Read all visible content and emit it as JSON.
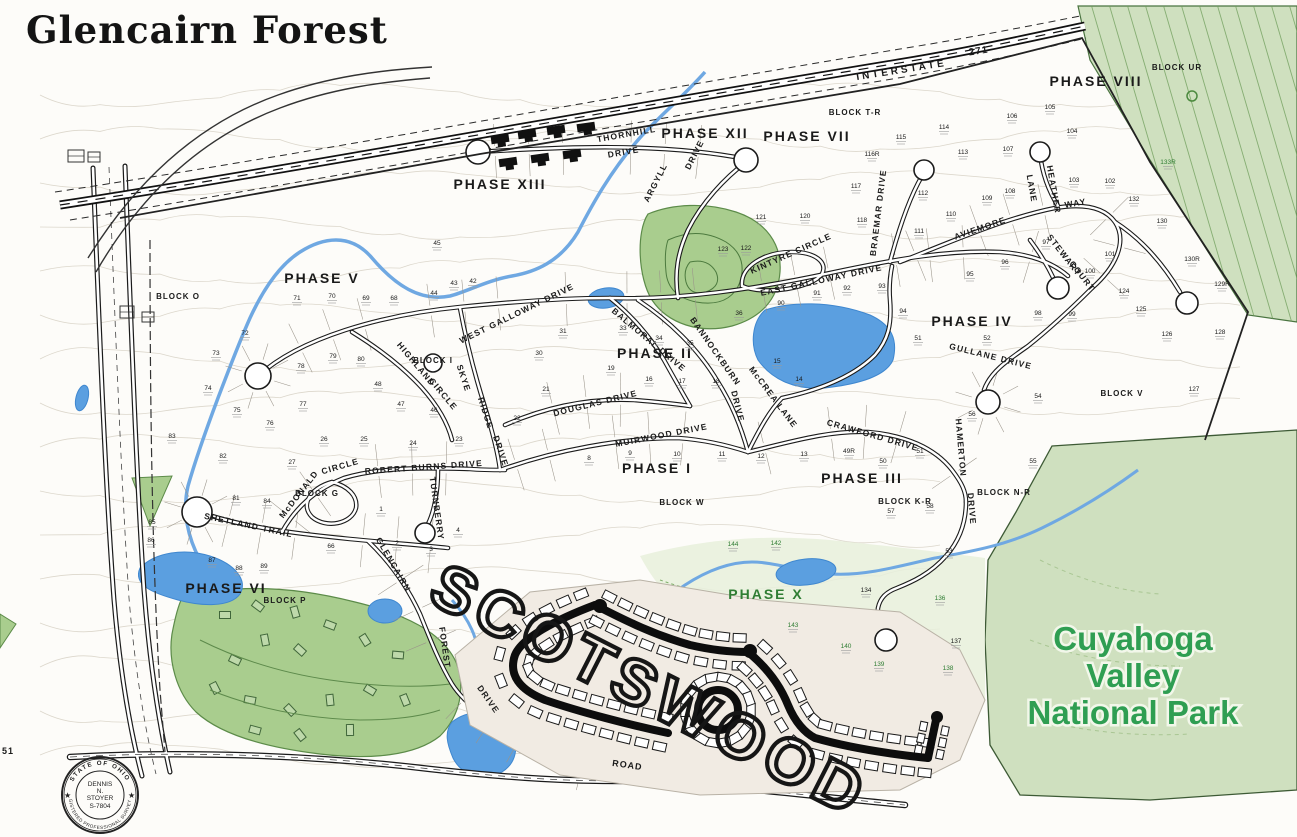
{
  "title": "Glencairn Forest",
  "park": {
    "lines": [
      "Cuyahoga",
      "Valley",
      "National Park"
    ],
    "color": "#2f9e52"
  },
  "scotswood": {
    "label": "SCOTSWOOD"
  },
  "interstate": {
    "name": "INTERSTATE",
    "number": "271"
  },
  "seal": {
    "ring_top": "STATE OF OHIO",
    "ring_bottom": "REGISTERED PROFESSIONAL SURVEYOR",
    "center": [
      "DENNIS",
      "N.",
      "STOYER",
      "S-7804"
    ]
  },
  "colors": {
    "label": "#1a1a1a",
    "green_label": "#2f7d33",
    "park_text": "#2f9e52",
    "water": "#5b9fe0",
    "water_edge": "#3f87cf",
    "woods": "#a9cd8e",
    "park_bg": "#cfe0bf",
    "road": "#1b1b1b"
  },
  "labels": {
    "phases": [
      {
        "t": "PHASE I",
        "x": 657,
        "y": 473
      },
      {
        "t": "PHASE II",
        "x": 655,
        "y": 358
      },
      {
        "t": "PHASE III",
        "x": 862,
        "y": 483
      },
      {
        "t": "PHASE IV",
        "x": 972,
        "y": 326
      },
      {
        "t": "PHASE V",
        "x": 322,
        "y": 283
      },
      {
        "t": "PHASE VI",
        "x": 226,
        "y": 593
      },
      {
        "t": "PHASE VII",
        "x": 807,
        "y": 141
      },
      {
        "t": "PHASE VIII",
        "x": 1096,
        "y": 86
      },
      {
        "t": "PHASE XII",
        "x": 705,
        "y": 138
      },
      {
        "t": "PHASE XIII",
        "x": 500,
        "y": 189
      },
      {
        "t": "PHASE X",
        "x": 766,
        "y": 599,
        "c": "g"
      }
    ],
    "blocks": [
      {
        "t": "BLOCK O",
        "x": 178,
        "y": 299
      },
      {
        "t": "BLOCK T-R",
        "x": 855,
        "y": 115
      },
      {
        "t": "BLOCK UR",
        "x": 1177,
        "y": 70
      },
      {
        "t": "BLOCK G",
        "x": 317,
        "y": 496
      },
      {
        "t": "BLOCK W",
        "x": 682,
        "y": 505
      },
      {
        "t": "BLOCK V",
        "x": 1122,
        "y": 396
      },
      {
        "t": "BLOCK K-R",
        "x": 905,
        "y": 504
      },
      {
        "t": "BLOCK N-R",
        "x": 1004,
        "y": 495
      },
      {
        "t": "BLOCK P",
        "x": 285,
        "y": 603
      },
      {
        "t": "BLOCK I",
        "x": 433,
        "y": 363
      }
    ],
    "streets": [
      {
        "t": "THORNHILL",
        "x": 627,
        "y": 137,
        "r": -10
      },
      {
        "t": "DRIVE",
        "x": 624,
        "y": 155,
        "r": -10
      },
      {
        "t": "ARGYLL",
        "x": 658,
        "y": 184,
        "r": -63
      },
      {
        "t": "DRIVE",
        "x": 697,
        "y": 156,
        "r": -63
      },
      {
        "t": "KINTYRE CIRCLE",
        "x": 792,
        "y": 256,
        "r": -24
      },
      {
        "t": "EAST GALLOWAY DRIVE",
        "x": 822,
        "y": 283,
        "r": -12
      },
      {
        "t": "WEST GALLOWAY DRIVE",
        "x": 518,
        "y": 316,
        "r": -26
      },
      {
        "t": "BALMORAL DRIVE",
        "x": 647,
        "y": 342,
        "r": 40
      },
      {
        "t": "BANNOCKBURN",
        "x": 713,
        "y": 353,
        "r": 55
      },
      {
        "t": "DRIVE",
        "x": 735,
        "y": 407,
        "r": 76
      },
      {
        "t": "McCREA LANE",
        "x": 771,
        "y": 399,
        "r": 53
      },
      {
        "t": "BRAEMAR DRIVE",
        "x": 881,
        "y": 213,
        "r": -83
      },
      {
        "t": "AVIEMORE",
        "x": 981,
        "y": 231,
        "r": -19
      },
      {
        "t": "WAY",
        "x": 1076,
        "y": 206,
        "r": -10
      },
      {
        "t": "HEATHER",
        "x": 1051,
        "y": 190,
        "r": 80
      },
      {
        "t": "LANE",
        "x": 1029,
        "y": 189,
        "r": 80
      },
      {
        "t": "STEWART",
        "x": 1062,
        "y": 257,
        "r": 52
      },
      {
        "t": "COURT",
        "x": 1080,
        "y": 278,
        "r": 52
      },
      {
        "t": "GULLANE DRIVE",
        "x": 990,
        "y": 359,
        "r": 14
      },
      {
        "t": "CRAWFORD DRIVE",
        "x": 872,
        "y": 438,
        "r": 16
      },
      {
        "t": "HAMERTON",
        "x": 958,
        "y": 448,
        "r": 85
      },
      {
        "t": "DRIVE",
        "x": 969,
        "y": 509,
        "r": 85
      },
      {
        "t": "DOUGLAS DRIVE",
        "x": 596,
        "y": 406,
        "r": -14
      },
      {
        "t": "MUIRWOOD DRIVE",
        "x": 662,
        "y": 438,
        "r": -11
      },
      {
        "t": "SKYE",
        "x": 461,
        "y": 379,
        "r": 72
      },
      {
        "t": "RIDGE",
        "x": 483,
        "y": 414,
        "r": 72
      },
      {
        "t": "DRIVE",
        "x": 498,
        "y": 452,
        "r": 72
      },
      {
        "t": "HIGHLAND",
        "x": 414,
        "y": 366,
        "r": 50
      },
      {
        "t": "CIRCLE",
        "x": 441,
        "y": 396,
        "r": 50
      },
      {
        "t": "McDONALD",
        "x": 301,
        "y": 496,
        "r": -52
      },
      {
        "t": "CIRCLE",
        "x": 341,
        "y": 469,
        "r": -16
      },
      {
        "t": "ROBERT BURNS DRIVE",
        "x": 424,
        "y": 470,
        "r": -4
      },
      {
        "t": "TURNBERRY",
        "x": 434,
        "y": 509,
        "r": 82
      },
      {
        "t": "SHETLAND TRAIL",
        "x": 248,
        "y": 528,
        "r": 12
      },
      {
        "t": "GLENCAIRN",
        "x": 391,
        "y": 566,
        "r": 60
      },
      {
        "t": "FOREST",
        "x": 442,
        "y": 648,
        "r": 82
      },
      {
        "t": "DRIVE",
        "x": 486,
        "y": 701,
        "r": 55
      }
    ],
    "misc": [
      {
        "t": "INTERSTATE",
        "x": 902,
        "y": 73,
        "r": -9,
        "s": 10,
        "ls": 3
      },
      {
        "t": "271",
        "x": 979,
        "y": 54,
        "r": -9,
        "s": 10
      },
      {
        "t": "ROAD",
        "x": 627,
        "y": 768,
        "r": 8,
        "s": 9
      },
      {
        "t": "51",
        "x": 8,
        "y": 754,
        "r": 0,
        "s": 9
      }
    ],
    "lots": [
      [
        "115",
        901,
        139
      ],
      [
        "116R",
        872,
        156
      ],
      [
        "114",
        944,
        129
      ],
      [
        "113",
        963,
        154
      ],
      [
        "107",
        1008,
        151
      ],
      [
        "106",
        1012,
        118
      ],
      [
        "105",
        1050,
        109
      ],
      [
        "104",
        1072,
        133
      ],
      [
        "103",
        1074,
        182
      ],
      [
        "102",
        1110,
        183
      ],
      [
        "132",
        1134,
        201
      ],
      [
        "133R",
        1168,
        164,
        "g"
      ],
      [
        "130",
        1162,
        223
      ],
      [
        "130R",
        1192,
        261
      ],
      [
        "129R",
        1222,
        286
      ],
      [
        "128",
        1220,
        334
      ],
      [
        "127",
        1194,
        391
      ],
      [
        "101",
        1110,
        256
      ],
      [
        "100",
        1090,
        273
      ],
      [
        "124",
        1124,
        293
      ],
      [
        "125",
        1141,
        311
      ],
      [
        "126",
        1167,
        336
      ],
      [
        "108",
        1010,
        193
      ],
      [
        "109",
        987,
        200
      ],
      [
        "110",
        951,
        216
      ],
      [
        "111",
        919,
        233
      ],
      [
        "112",
        923,
        195
      ],
      [
        "117",
        856,
        188
      ],
      [
        "118",
        862,
        222
      ],
      [
        "121",
        761,
        219
      ],
      [
        "120",
        805,
        218
      ],
      [
        "122",
        746,
        250
      ],
      [
        "123",
        723,
        251
      ],
      [
        "97",
        1046,
        244
      ],
      [
        "96",
        1005,
        264
      ],
      [
        "95",
        970,
        276
      ],
      [
        "98",
        1038,
        315
      ],
      [
        "99",
        1072,
        316
      ],
      [
        "92",
        847,
        290
      ],
      [
        "93",
        882,
        288
      ],
      [
        "91",
        817,
        295
      ],
      [
        "90",
        781,
        305
      ],
      [
        "94",
        903,
        313
      ],
      [
        "51",
        918,
        340
      ],
      [
        "52",
        987,
        340
      ],
      [
        "49R",
        849,
        453
      ],
      [
        "50",
        883,
        463
      ],
      [
        "51",
        920,
        453
      ],
      [
        "56",
        972,
        416
      ],
      [
        "54",
        1038,
        398
      ],
      [
        "55",
        1033,
        463
      ],
      [
        "57",
        891,
        513
      ],
      [
        "58",
        930,
        508
      ],
      [
        "53",
        949,
        553
      ],
      [
        "33",
        623,
        330
      ],
      [
        "34",
        659,
        340
      ],
      [
        "35",
        690,
        345
      ],
      [
        "36",
        739,
        315
      ],
      [
        "31",
        563,
        333
      ],
      [
        "30",
        539,
        355
      ],
      [
        "19",
        611,
        370
      ],
      [
        "21",
        546,
        391
      ],
      [
        "22",
        517,
        420
      ],
      [
        "16",
        649,
        381
      ],
      [
        "17",
        682,
        383
      ],
      [
        "18",
        716,
        383
      ],
      [
        "15",
        777,
        363
      ],
      [
        "14",
        799,
        381
      ],
      [
        "23",
        459,
        441
      ],
      [
        "8",
        589,
        460
      ],
      [
        "9",
        630,
        455
      ],
      [
        "10",
        677,
        456
      ],
      [
        "11",
        722,
        456
      ],
      [
        "12",
        761,
        458
      ],
      [
        "13",
        804,
        456
      ],
      [
        "71",
        297,
        300
      ],
      [
        "70",
        332,
        298
      ],
      [
        "69",
        366,
        300
      ],
      [
        "68",
        394,
        300
      ],
      [
        "44",
        434,
        295
      ],
      [
        "43",
        454,
        285
      ],
      [
        "42",
        473,
        283
      ],
      [
        "45",
        437,
        245
      ],
      [
        "72",
        245,
        335
      ],
      [
        "73",
        216,
        355
      ],
      [
        "74",
        208,
        390
      ],
      [
        "78",
        301,
        368
      ],
      [
        "79",
        333,
        358
      ],
      [
        "80",
        361,
        361
      ],
      [
        "48",
        378,
        386
      ],
      [
        "47",
        401,
        406
      ],
      [
        "77",
        303,
        406
      ],
      [
        "46",
        434,
        412
      ],
      [
        "83",
        172,
        438
      ],
      [
        "82",
        223,
        458
      ],
      [
        "75",
        237,
        412
      ],
      [
        "76",
        270,
        425
      ],
      [
        "26",
        324,
        441
      ],
      [
        "25",
        364,
        441
      ],
      [
        "24",
        413,
        445
      ],
      [
        "27",
        292,
        464
      ],
      [
        "81",
        236,
        500
      ],
      [
        "84",
        267,
        503
      ],
      [
        "85",
        152,
        524
      ],
      [
        "86",
        151,
        542
      ],
      [
        "87",
        212,
        562
      ],
      [
        "88",
        239,
        570
      ],
      [
        "89",
        264,
        568
      ],
      [
        "66",
        331,
        548
      ],
      [
        "1",
        381,
        511
      ],
      [
        "2",
        397,
        545
      ],
      [
        "3",
        431,
        551
      ],
      [
        "4",
        458,
        532
      ],
      [
        "134",
        866,
        592
      ],
      [
        "136",
        940,
        600,
        "g"
      ],
      [
        "137",
        956,
        643
      ],
      [
        "138",
        948,
        670,
        "g"
      ],
      [
        "139",
        879,
        666,
        "g"
      ],
      [
        "140",
        846,
        648,
        "g"
      ],
      [
        "142",
        776,
        545,
        "g"
      ],
      [
        "143",
        793,
        627,
        "g"
      ],
      [
        "144",
        733,
        546,
        "g"
      ]
    ]
  }
}
